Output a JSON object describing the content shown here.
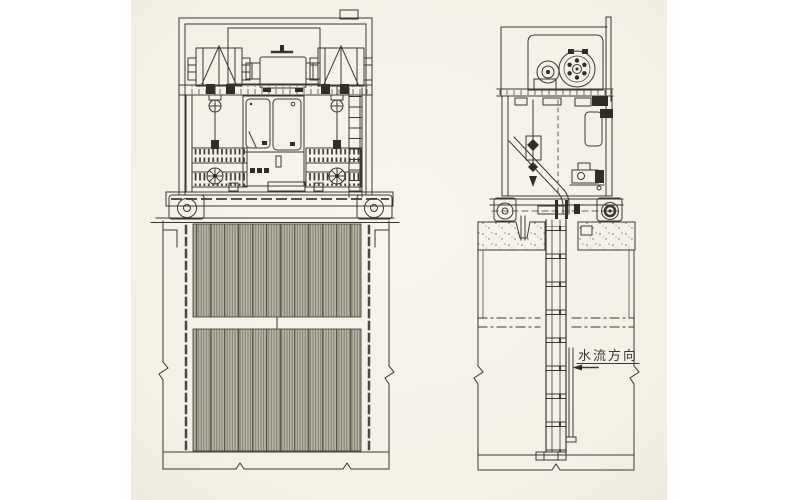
{
  "photo": {
    "description": "Photographed engineering drawing of a mechanical bar screen with traveling rake hoist: front elevation (left) and side elevation (right), screen bars descending into a concrete water channel",
    "paper_color": "#f4f2e8",
    "page_background": "#ffffff",
    "ink_color": "#3a3833",
    "screen_bar_fill": "#b7b5a6"
  },
  "labels": {
    "flow_direction": "水流方向"
  }
}
